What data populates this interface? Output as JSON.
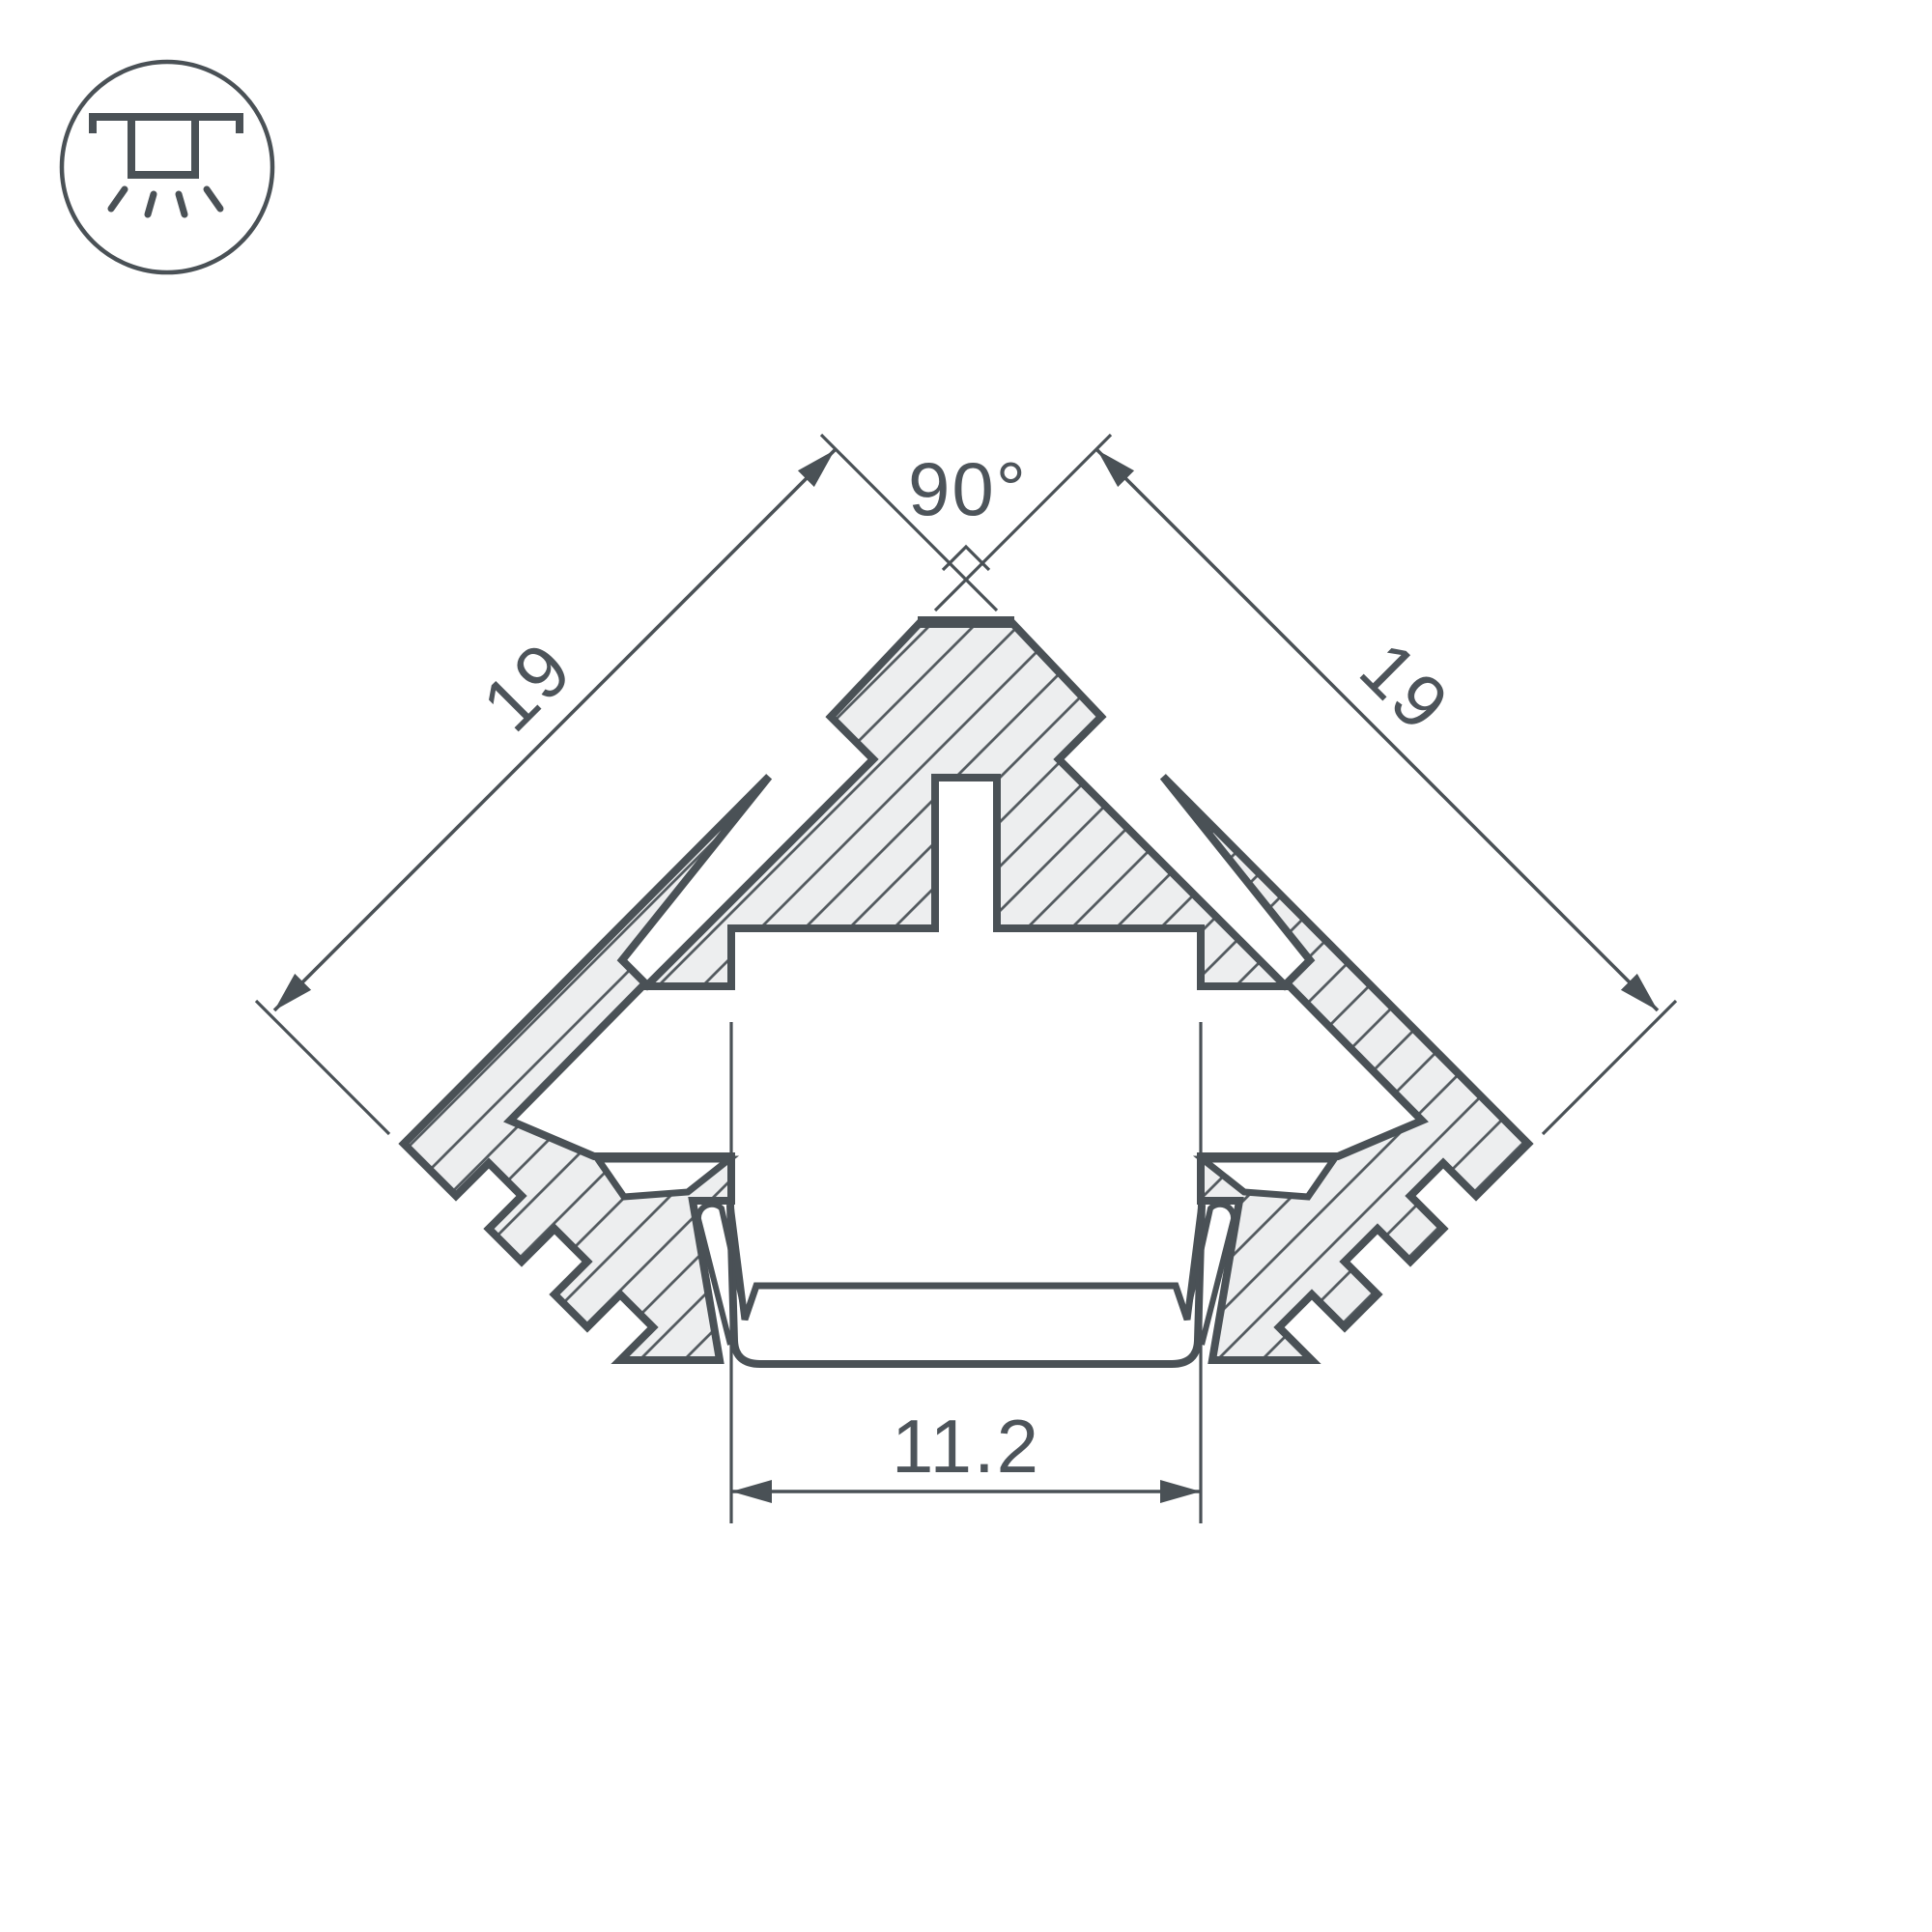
{
  "diagram": {
    "title": "LED corner profile cross-section drawing",
    "icon": "recessed-ceiling-light-icon",
    "labels": {
      "angle_top": "90°",
      "side_left": "19",
      "side_right": "19",
      "width_bottom": "11.2"
    },
    "colors": {
      "background": "#ffffff",
      "outline": "#4a5156",
      "hatch_line": "#545b60",
      "aluminum_fill": "#edeeef",
      "text": "#4d545a"
    }
  }
}
